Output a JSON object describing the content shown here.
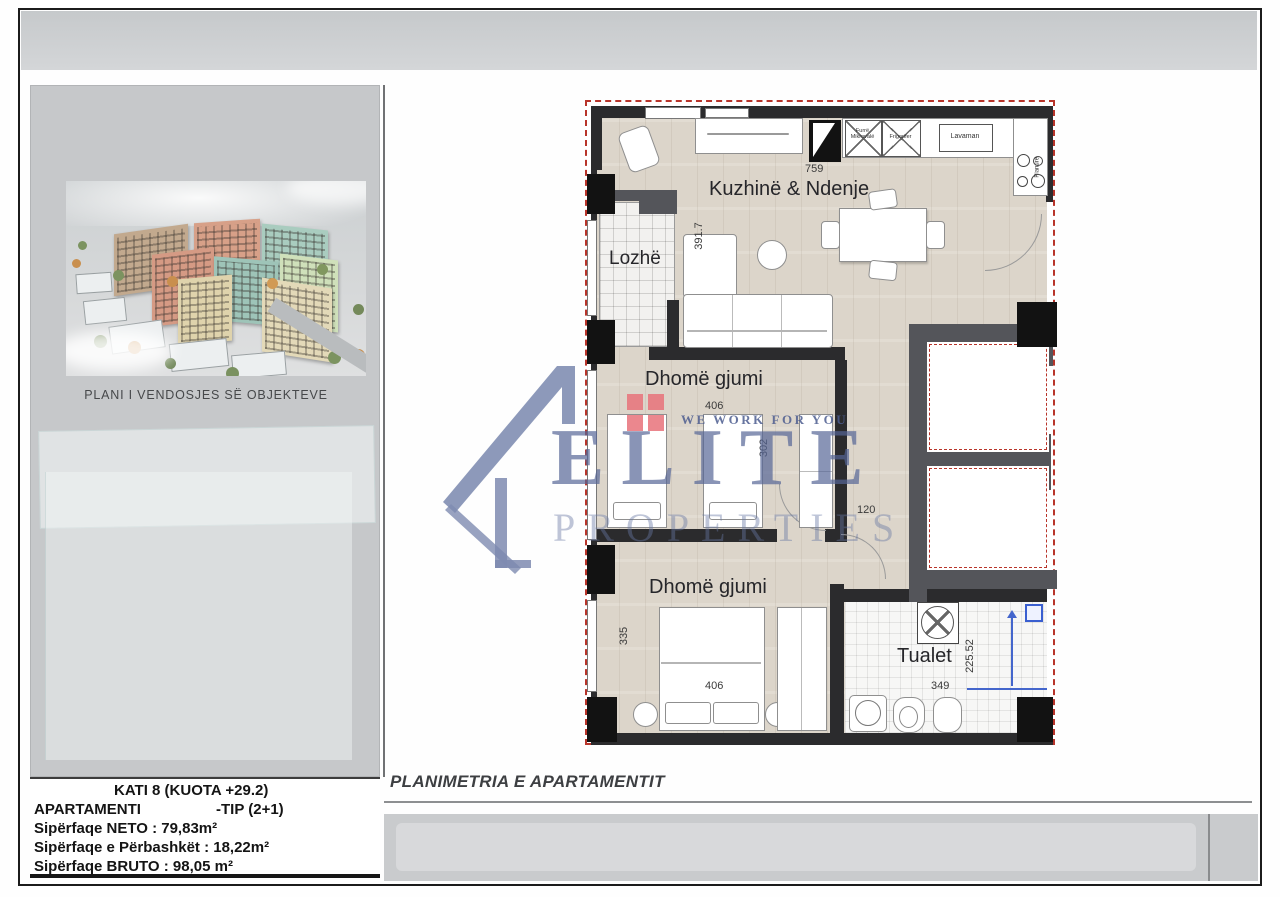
{
  "sidebar": {
    "caption": "PLANI I VENDOSJES SË OBJEKTEVE",
    "info": {
      "floor": "KATI 8 (KUOTA +29.2)",
      "apartment_label": "APARTAMENTI",
      "apartment_type": "-TIP (2+1)",
      "area_net": "Sipërfaqe NETO : 79,83m²",
      "area_shared": "Sipërfaqe e Përbashkët : 18,22m²",
      "area_gross": "Sipërfaqe BRUTO : 98,05 m²"
    }
  },
  "main": {
    "plan_title": "PLANIMETRIA E APARTAMENTIT"
  },
  "floorplan": {
    "rooms": {
      "kitchen_living": {
        "label": "Kuzhinë & Ndenje",
        "dim_width": "759",
        "dim_height": "391.7"
      },
      "loggia": {
        "label": "Lozhë"
      },
      "bedroom1": {
        "label": "Dhomë gjumi",
        "dim_width": "406",
        "dim_height": "302"
      },
      "bedroom2": {
        "label": "Dhomë gjumi",
        "dim_width": "406",
        "dim_height": "335"
      },
      "toilet": {
        "label": "Tualet",
        "dim_width": "349",
        "dim_height": "225.52"
      },
      "corridor": {
        "dim_width": "120"
      }
    },
    "fixtures": {
      "microwave_oven": "Furrë\nMikrovalë",
      "fridge": "Frigorifer",
      "sink": "Lavaman",
      "cooktop": "Pianurë"
    }
  },
  "watermark": {
    "brand": "ELITE",
    "brand_sub": "PROPERTIES",
    "tagline": "WE WORK FOR YOU"
  },
  "colors": {
    "boundary_red": "#b8342a",
    "wall_dark": "#2b2b2d",
    "wall_gray": "#54555a",
    "watermark_blue": "#5f6e9e",
    "logo_red": "#e8737b",
    "floor_wood": "#dcd5ca",
    "panel_gray": "#c7c9cb"
  }
}
